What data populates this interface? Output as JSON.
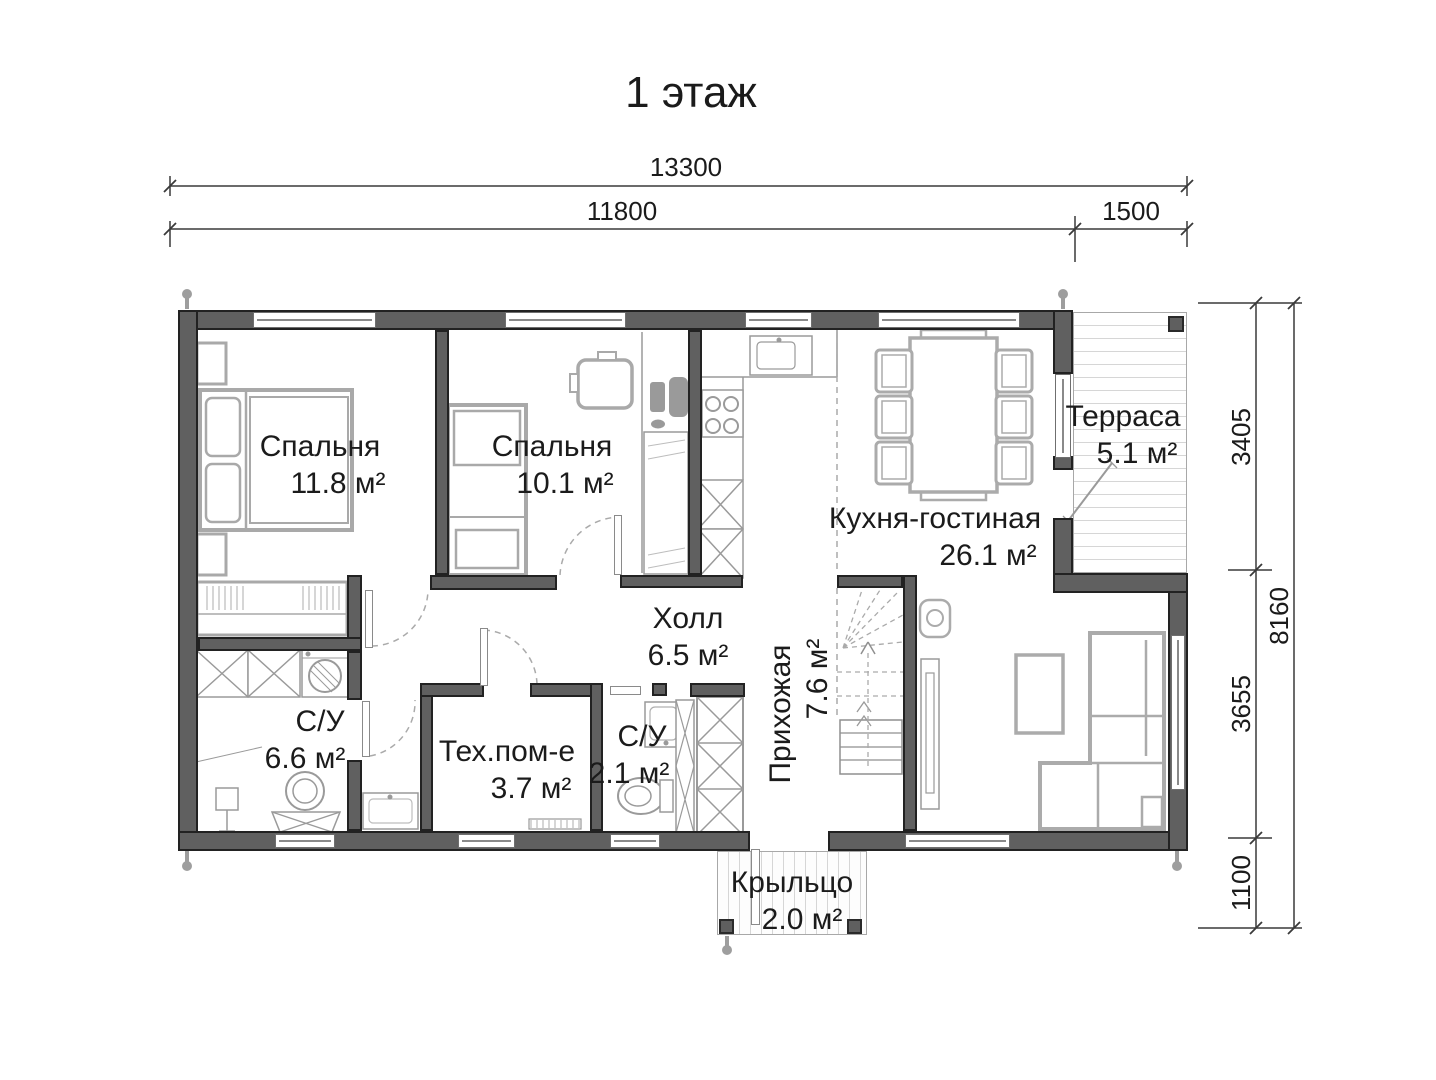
{
  "title": "1 этаж",
  "dimensions": {
    "top_total": "13300",
    "top_left": "11800",
    "top_right": "1500",
    "side_upper": "3405",
    "side_middle": "3655",
    "side_lower": "1100",
    "side_total": "8160"
  },
  "rooms": [
    {
      "name": "Спальня",
      "area": "11.8 м²"
    },
    {
      "name": "Спальня",
      "area": "10.1 м²"
    },
    {
      "name": "Кухня-гостиная",
      "area": "26.1 м²"
    },
    {
      "name": "Терраса",
      "area": "5.1 м²"
    },
    {
      "name": "Холл",
      "area": "6.5 м²"
    },
    {
      "name": "Прихожая",
      "area": "7.6 м²"
    },
    {
      "name": "С/У",
      "area": "6.6 м²"
    },
    {
      "name": "Тех.пом-е",
      "area": "3.7 м²"
    },
    {
      "name": "С/У",
      "area": "2.1 м²"
    },
    {
      "name": "Крыльцо",
      "area": "2.0 м²"
    }
  ]
}
